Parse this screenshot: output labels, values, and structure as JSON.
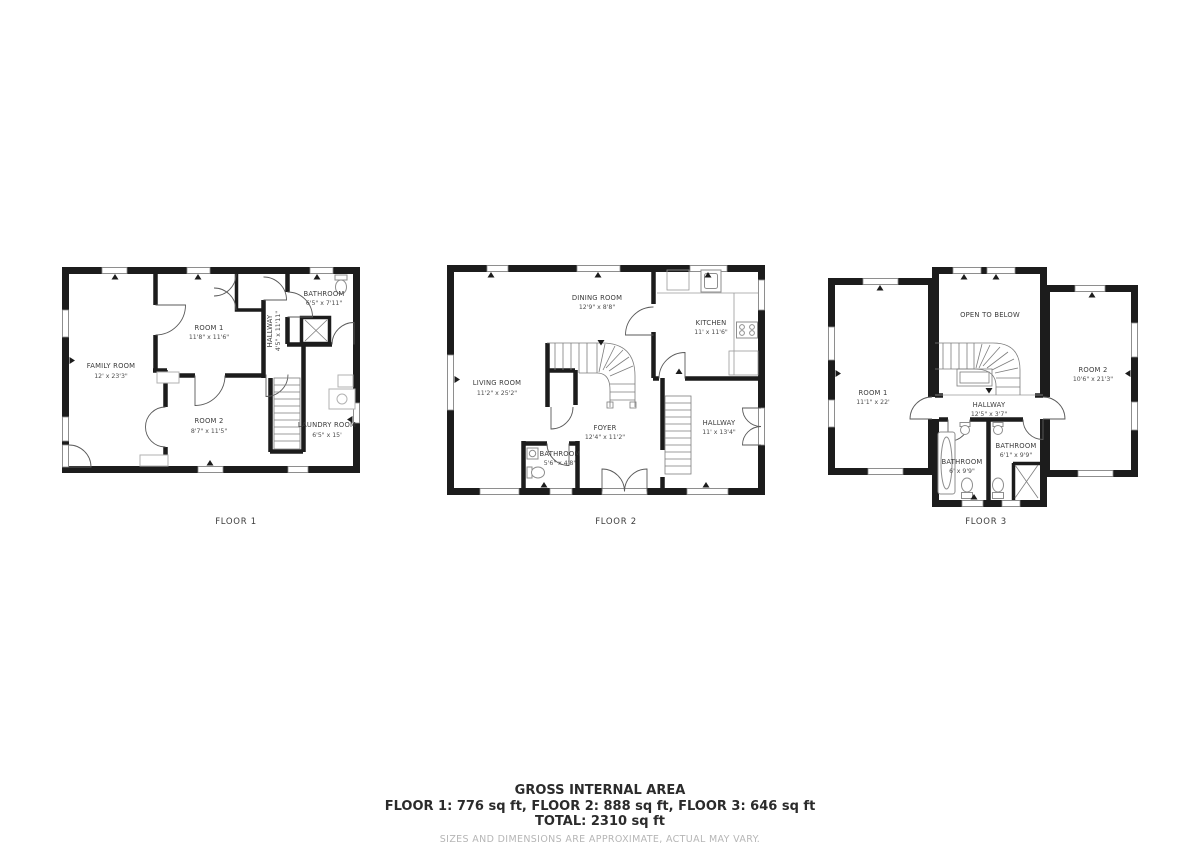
{
  "colors": {
    "wall": "#1c1c1c",
    "text": "#3b3b3b",
    "dims_text": "#4d4d4d",
    "fixture": "#8e8e8e",
    "disclaimer": "#b6b6b6",
    "background": "#ffffff"
  },
  "floors": [
    {
      "label": "FLOOR 1",
      "rooms": [
        {
          "name": "FAMILY ROOM",
          "dims": "12' x 23'3\""
        },
        {
          "name": "ROOM 1",
          "dims": "11'8\" x 11'6\""
        },
        {
          "name": "HALLWAY",
          "dims": "4'5\" x 11'11\""
        },
        {
          "name": "BATHROOM",
          "dims": "6'5\" x 7'11\""
        },
        {
          "name": "ROOM 2",
          "dims": "8'7\" x 11'5\""
        },
        {
          "name": "LAUNDRY ROOM",
          "dims": "6'5\" x 15'"
        }
      ]
    },
    {
      "label": "FLOOR 2",
      "rooms": [
        {
          "name": "DINING ROOM",
          "dims": "12'9\" x 8'8\""
        },
        {
          "name": "KITCHEN",
          "dims": "11' x 11'6\""
        },
        {
          "name": "LIVING ROOM",
          "dims": "11'2\" x 25'2\""
        },
        {
          "name": "FOYER",
          "dims": "12'4\" x 11'2\""
        },
        {
          "name": "BATHROOM",
          "dims": "5'6\" x 4'8\""
        },
        {
          "name": "HALLWAY",
          "dims": "11' x 13'4\""
        }
      ]
    },
    {
      "label": "FLOOR 3",
      "rooms": [
        {
          "name": "ROOM 1",
          "dims": "11'1\" x 22'"
        },
        {
          "name": "OPEN TO BELOW",
          "dims": ""
        },
        {
          "name": "ROOM 2",
          "dims": "10'6\" x 21'3\""
        },
        {
          "name": "HALLWAY",
          "dims": "12'5\" x 3'7\""
        },
        {
          "name": "BATHROOM",
          "dims": "6' x 9'9\""
        },
        {
          "name": "BATHROOM",
          "dims": "6'1\" x 9'9\""
        }
      ]
    }
  ],
  "footer": {
    "title": "GROSS INTERNAL AREA",
    "floor_areas": "FLOOR 1: 776 sq ft, FLOOR 2: 888 sq ft, FLOOR 3: 646 sq ft",
    "total": "TOTAL: 2310 sq ft",
    "disclaimer": "SIZES AND DIMENSIONS ARE APPROXIMATE, ACTUAL MAY VARY."
  }
}
